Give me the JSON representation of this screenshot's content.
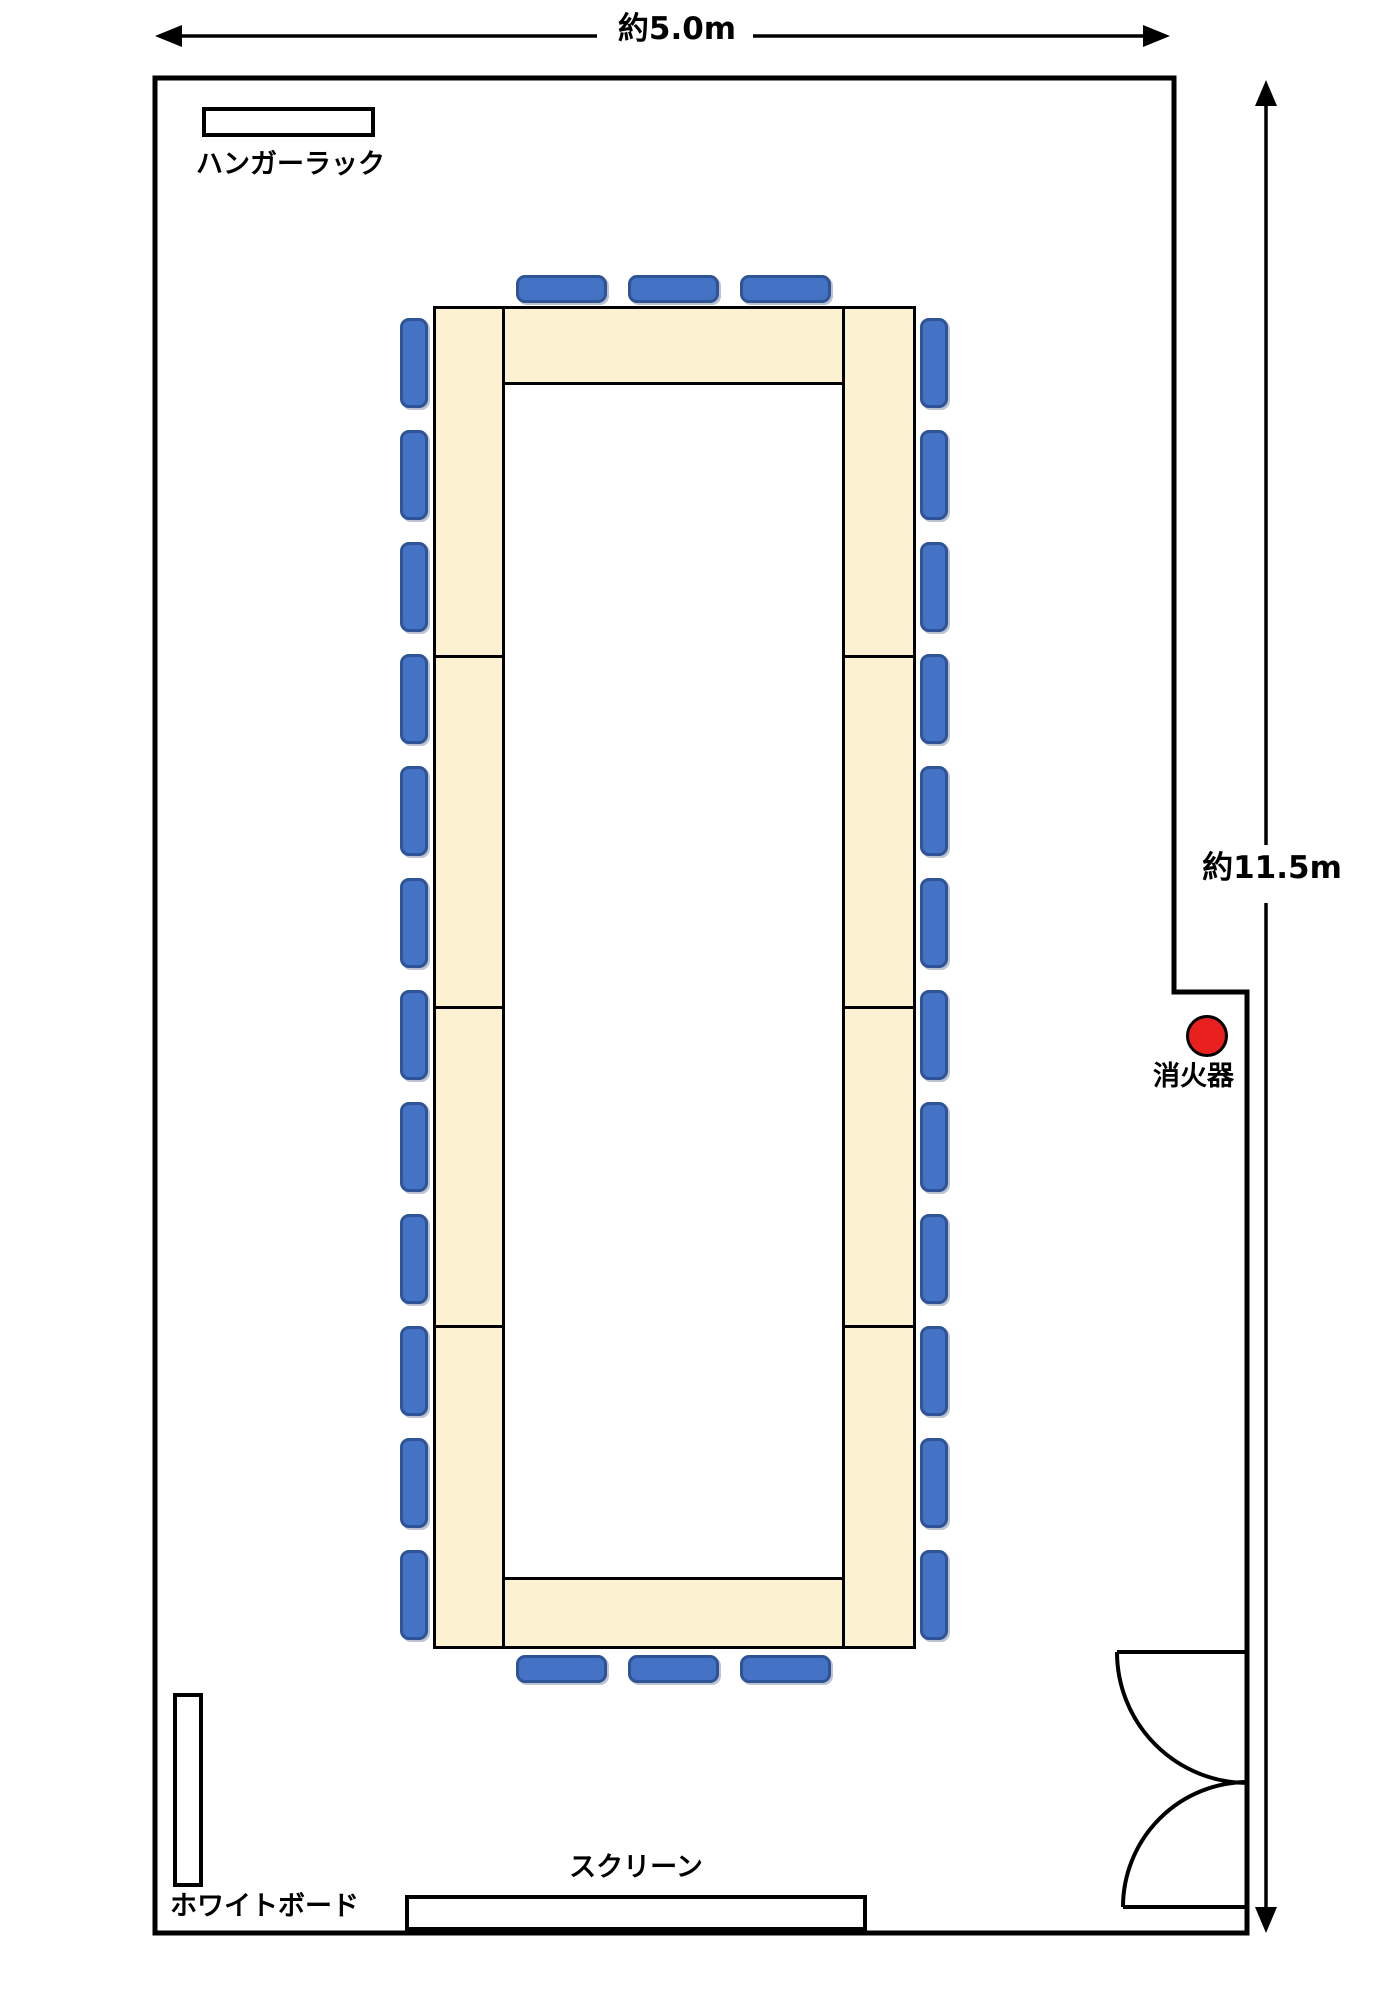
{
  "labels": {
    "width_dimension": "約5.0m",
    "height_dimension": "約11.5m",
    "hanger_rack": "ハンガーラック",
    "whiteboard": "ホワイトボード",
    "screen": "スクリーン",
    "fire_extinguisher": "消火器"
  },
  "colors": {
    "table_fill": "#fcf2d2",
    "chair_fill": "#4472c4",
    "chair_border": "#2f5496",
    "extinguisher_fill": "#e8201e",
    "line_color": "#000000"
  },
  "floorplan": {
    "table_blocks": [
      {
        "id": "table-column-left",
        "x": 433,
        "y": 306,
        "w": 72,
        "h": 1343,
        "dividers_y": [
          655,
          1006,
          1325
        ]
      },
      {
        "id": "table-column-right",
        "x": 842,
        "y": 306,
        "w": 74,
        "h": 1343,
        "dividers_y": [
          655,
          1006,
          1325
        ]
      },
      {
        "id": "table-row-top",
        "x": 502,
        "y": 306,
        "w": 343,
        "h": 79,
        "dividers_y": []
      },
      {
        "id": "table-row-bottom",
        "x": 502,
        "y": 1577,
        "w": 343,
        "h": 72,
        "dividers_y": []
      }
    ],
    "chair_groups": [
      {
        "id": "chairs-left",
        "orientation": "vertical",
        "x": 400,
        "y_start": 318,
        "count": 12,
        "pitch": 112,
        "w": 28,
        "h": 90
      },
      {
        "id": "chairs-right",
        "orientation": "vertical",
        "x": 920,
        "y_start": 318,
        "count": 12,
        "pitch": 112,
        "w": 28,
        "h": 90
      },
      {
        "id": "chairs-top",
        "orientation": "horizontal",
        "y": 275,
        "x_start": 516,
        "count": 3,
        "pitch": 112,
        "w": 91,
        "h": 28
      },
      {
        "id": "chairs-bottom",
        "orientation": "horizontal",
        "y": 1655,
        "x_start": 516,
        "count": 3,
        "pitch": 112,
        "w": 91,
        "h": 28
      }
    ],
    "fixtures": [
      {
        "id": "hanger-rack",
        "x": 202,
        "y": 107,
        "w": 173,
        "h": 30
      },
      {
        "id": "whiteboard",
        "x": 173,
        "y": 1693,
        "w": 30,
        "h": 194
      },
      {
        "id": "screen",
        "x": 405,
        "y": 1895,
        "w": 462,
        "h": 36
      }
    ],
    "extinguisher": {
      "cx": 1207,
      "cy": 1036,
      "r": 21
    }
  }
}
